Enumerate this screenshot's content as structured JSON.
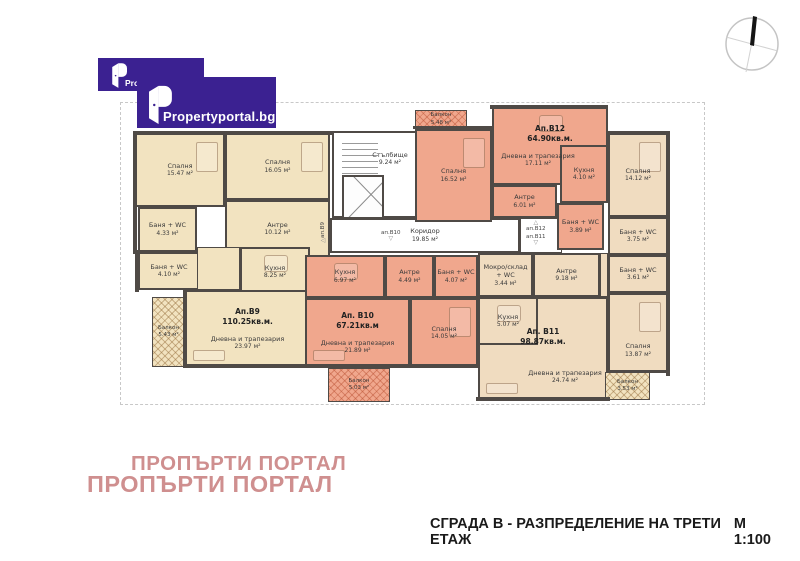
{
  "colors": {
    "wall": "#4f4a46",
    "b9": "#f2e3c0",
    "b10": "#f0a78d",
    "b11": "#f0dcc0",
    "b12": "#f0a78d",
    "dash": "#c8c8c8",
    "brand": "#3b2191",
    "wm": "#cf8f8f",
    "title": "#1a1a1a"
  },
  "logo": {
    "brand": "Propertyportal.bg",
    "brand_partial": "Pro"
  },
  "watermark": {
    "line1": "ПРОПЪРТИ ПОРТАЛ",
    "line2": "ПРОПЪРТИ ПОРТАЛ"
  },
  "footer": {
    "title": "СГРАДА В - РАЗПРЕДЕЛЕНИЕ НА ТРЕТИ ЕТАЖ",
    "scale": "М 1:100"
  },
  "floorplan": {
    "boundary": {
      "x": 120,
      "y": 102,
      "w": 583,
      "h": 301
    },
    "rooms": [
      {
        "id": "b9-bedroom-1",
        "apt": "b9",
        "name": "Спалня",
        "area": "15.47 м²",
        "x": 135,
        "y": 133,
        "w": 90,
        "h": 74,
        "furn": "bed"
      },
      {
        "id": "b9-bedroom-2",
        "apt": "b9",
        "name": "Спалня",
        "area": "16.05 м²",
        "x": 225,
        "y": 133,
        "w": 105,
        "h": 67,
        "furn": "bed"
      },
      {
        "id": "b9-bath-1",
        "apt": "b9",
        "name": "Баня + WC",
        "area": "4.33 м²",
        "x": 138,
        "y": 207,
        "w": 59,
        "h": 45
      },
      {
        "id": "b9-hall",
        "apt": "b9",
        "name": "Антре",
        "area": "10.12 м²",
        "x": 225,
        "y": 200,
        "w": 105,
        "h": 58
      },
      {
        "id": "b9-bath-2",
        "apt": "b9",
        "name": "Баня + WC",
        "area": "4.10 м²",
        "x": 138,
        "y": 252,
        "w": 62,
        "h": 38
      },
      {
        "id": "b9-passage",
        "apt": "b9",
        "x": 197,
        "y": 247,
        "w": 43,
        "h": 43,
        "filler": true
      },
      {
        "id": "b9-kitchen",
        "apt": "b9",
        "name": "Кухня",
        "area": "8.25 м²",
        "x": 240,
        "y": 247,
        "w": 70,
        "h": 50,
        "furn": "table"
      },
      {
        "id": "b9-living",
        "apt": "b9",
        "name": "Дневна и трапезария",
        "area": "23.97 м²",
        "x": 185,
        "y": 290,
        "w": 125,
        "h": 78,
        "apt_label": "Ап.B9",
        "apt_area": "110.25кв.м.",
        "furn": "sofa"
      },
      {
        "id": "b9-balcony",
        "apt": "b9",
        "balcony": true,
        "name": "Балкон",
        "area": "5.43 м²",
        "x": 152,
        "y": 297,
        "w": 33,
        "h": 70
      },
      {
        "id": "stairwell",
        "apt": "common",
        "name": "Стълбище",
        "area": "9.24 м²",
        "x": 332,
        "y": 131,
        "w": 88,
        "h": 87,
        "special": "stair"
      },
      {
        "id": "corridor",
        "apt": "common",
        "name": "Коридор",
        "area": "19.85 м²",
        "x": 330,
        "y": 218,
        "w": 190,
        "h": 35
      },
      {
        "id": "entry-niche",
        "apt": "common",
        "x": 520,
        "y": 218,
        "w": 42,
        "h": 35,
        "filler": true
      },
      {
        "id": "b12-balcony",
        "apt": "b12",
        "balcony": true,
        "name": "Балкон",
        "area": "5.48 м²",
        "x": 415,
        "y": 110,
        "w": 52,
        "h": 19
      },
      {
        "id": "b12-bedroom",
        "apt": "b12",
        "name": "Спалня",
        "area": "16.52 м²",
        "x": 415,
        "y": 129,
        "w": 77,
        "h": 93,
        "furn": "bed"
      },
      {
        "id": "b12-living",
        "apt": "b12",
        "name": "Дневна и трапезария",
        "area": "17.11 м²",
        "x": 492,
        "y": 107,
        "w": 116,
        "h": 78,
        "apt_label": "Ап.B12",
        "apt_area": "64.90кв.м.",
        "furn": "table",
        "ldx": -12
      },
      {
        "id": "b12-kitchen",
        "apt": "b12",
        "name": "Кухня",
        "area": "4.10 м²",
        "x": 560,
        "y": 145,
        "w": 48,
        "h": 58
      },
      {
        "id": "b12-hall",
        "apt": "b12",
        "name": "Антре",
        "area": "6.01 м²",
        "x": 492,
        "y": 185,
        "w": 65,
        "h": 33
      },
      {
        "id": "b12-bath",
        "apt": "b12",
        "name": "Баня + WC",
        "area": "3.89 м²",
        "x": 557,
        "y": 203,
        "w": 47,
        "h": 47
      },
      {
        "id": "b11-bedroom-1",
        "apt": "b11",
        "name": "Спалня",
        "area": "14.12 м²",
        "x": 608,
        "y": 133,
        "w": 60,
        "h": 84,
        "furn": "bed"
      },
      {
        "id": "b11-bath-1",
        "apt": "b11",
        "name": "Баня + WC",
        "area": "3.75 м²",
        "x": 608,
        "y": 217,
        "w": 60,
        "h": 38
      },
      {
        "id": "b11-bath-2",
        "apt": "b11",
        "name": "Баня + WC",
        "area": "3.61 м²",
        "x": 608,
        "y": 255,
        "w": 60,
        "h": 38
      },
      {
        "id": "b11-laundry",
        "apt": "b11",
        "name": "Мокро/склад + WC",
        "area": "3.44 м²",
        "x": 478,
        "y": 253,
        "w": 55,
        "h": 44
      },
      {
        "id": "b11-hall",
        "apt": "b11",
        "name": "Антре",
        "area": "9.18 м²",
        "x": 533,
        "y": 253,
        "w": 67,
        "h": 44
      },
      {
        "id": "b11-strip",
        "apt": "b11",
        "x": 600,
        "y": 253,
        "w": 8,
        "h": 44,
        "filler": true
      },
      {
        "id": "b11-living",
        "apt": "b11",
        "name": "Дневна и трапезария",
        "area": "24.74 м²",
        "x": 478,
        "y": 297,
        "w": 130,
        "h": 104,
        "apt_label": "Ап. B11",
        "apt_area": "98.87кв.м.",
        "furn": "sofa",
        "ldx": 22,
        "ldy": 14
      },
      {
        "id": "b11-kitchen",
        "apt": "b11",
        "name": "Кухня",
        "area": "5.07 м²",
        "x": 478,
        "y": 297,
        "w": 60,
        "h": 48,
        "furn": "table"
      },
      {
        "id": "b11-bedroom-2",
        "apt": "b11",
        "name": "Спалня",
        "area": "13.87 м²",
        "x": 608,
        "y": 293,
        "w": 60,
        "h": 79,
        "furn": "bed",
        "ldy": 18
      },
      {
        "id": "b11-balcony",
        "apt": "b11",
        "balcony": true,
        "name": "Балкон",
        "area": "3.53 м²",
        "x": 605,
        "y": 372,
        "w": 45,
        "h": 28
      },
      {
        "id": "b10-kitchen",
        "apt": "b10",
        "name": "Кухня",
        "area": "6.97 м²",
        "x": 305,
        "y": 255,
        "w": 80,
        "h": 43,
        "furn": "table"
      },
      {
        "id": "b10-hall",
        "apt": "b10",
        "name": "Антре",
        "area": "4.49 м²",
        "x": 385,
        "y": 255,
        "w": 49,
        "h": 43
      },
      {
        "id": "b10-bath",
        "apt": "b10",
        "name": "Баня + WC",
        "area": "4.07 м²",
        "x": 434,
        "y": 255,
        "w": 44,
        "h": 43
      },
      {
        "id": "b10-living",
        "apt": "b10",
        "name": "Дневна и трапезария",
        "area": "21.89 м²",
        "x": 305,
        "y": 298,
        "w": 105,
        "h": 70,
        "apt_label": "Ап. B10",
        "apt_area": "67.21кв.м",
        "furn": "sofa"
      },
      {
        "id": "b10-bedroom",
        "apt": "b10",
        "name": "Спалня",
        "area": "14.05 м²",
        "x": 410,
        "y": 298,
        "w": 68,
        "h": 70,
        "furn": "bed"
      },
      {
        "id": "b10-balcony",
        "apt": "b10",
        "balcony": true,
        "name": "Балкон",
        "area": "5.03 м²",
        "x": 328,
        "y": 368,
        "w": 62,
        "h": 34
      }
    ],
    "markers": [
      {
        "id": "b9",
        "text": "ап.B9",
        "x": 320,
        "y": 222,
        "vertical": true,
        "arrow": "left"
      },
      {
        "id": "b10",
        "text": "ап.B10",
        "x": 381,
        "y": 230,
        "arrow": "down"
      },
      {
        "id": "b12",
        "text": "ап.B12",
        "x": 526,
        "y": 220,
        "arrow": "up"
      },
      {
        "id": "b11",
        "text": "ап.B11",
        "x": 526,
        "y": 234,
        "arrow": "down"
      }
    ],
    "walls": [
      {
        "x": 133,
        "y": 131,
        "w": 199,
        "h": 4
      },
      {
        "x": 490,
        "y": 105,
        "w": 118,
        "h": 4
      },
      {
        "x": 606,
        "y": 131,
        "w": 64,
        "h": 4
      },
      {
        "x": 133,
        "y": 131,
        "w": 4,
        "h": 123
      },
      {
        "x": 666,
        "y": 131,
        "w": 4,
        "h": 245
      },
      {
        "x": 183,
        "y": 364,
        "w": 297,
        "h": 4
      },
      {
        "x": 476,
        "y": 397,
        "w": 134,
        "h": 4
      },
      {
        "x": 648,
        "y": 370,
        "w": 22,
        "h": 3
      },
      {
        "x": 413,
        "y": 126,
        "w": 81,
        "h": 3
      },
      {
        "x": 135,
        "y": 250,
        "w": 4,
        "h": 42
      },
      {
        "x": 183,
        "y": 288,
        "w": 4,
        "h": 80
      }
    ]
  }
}
